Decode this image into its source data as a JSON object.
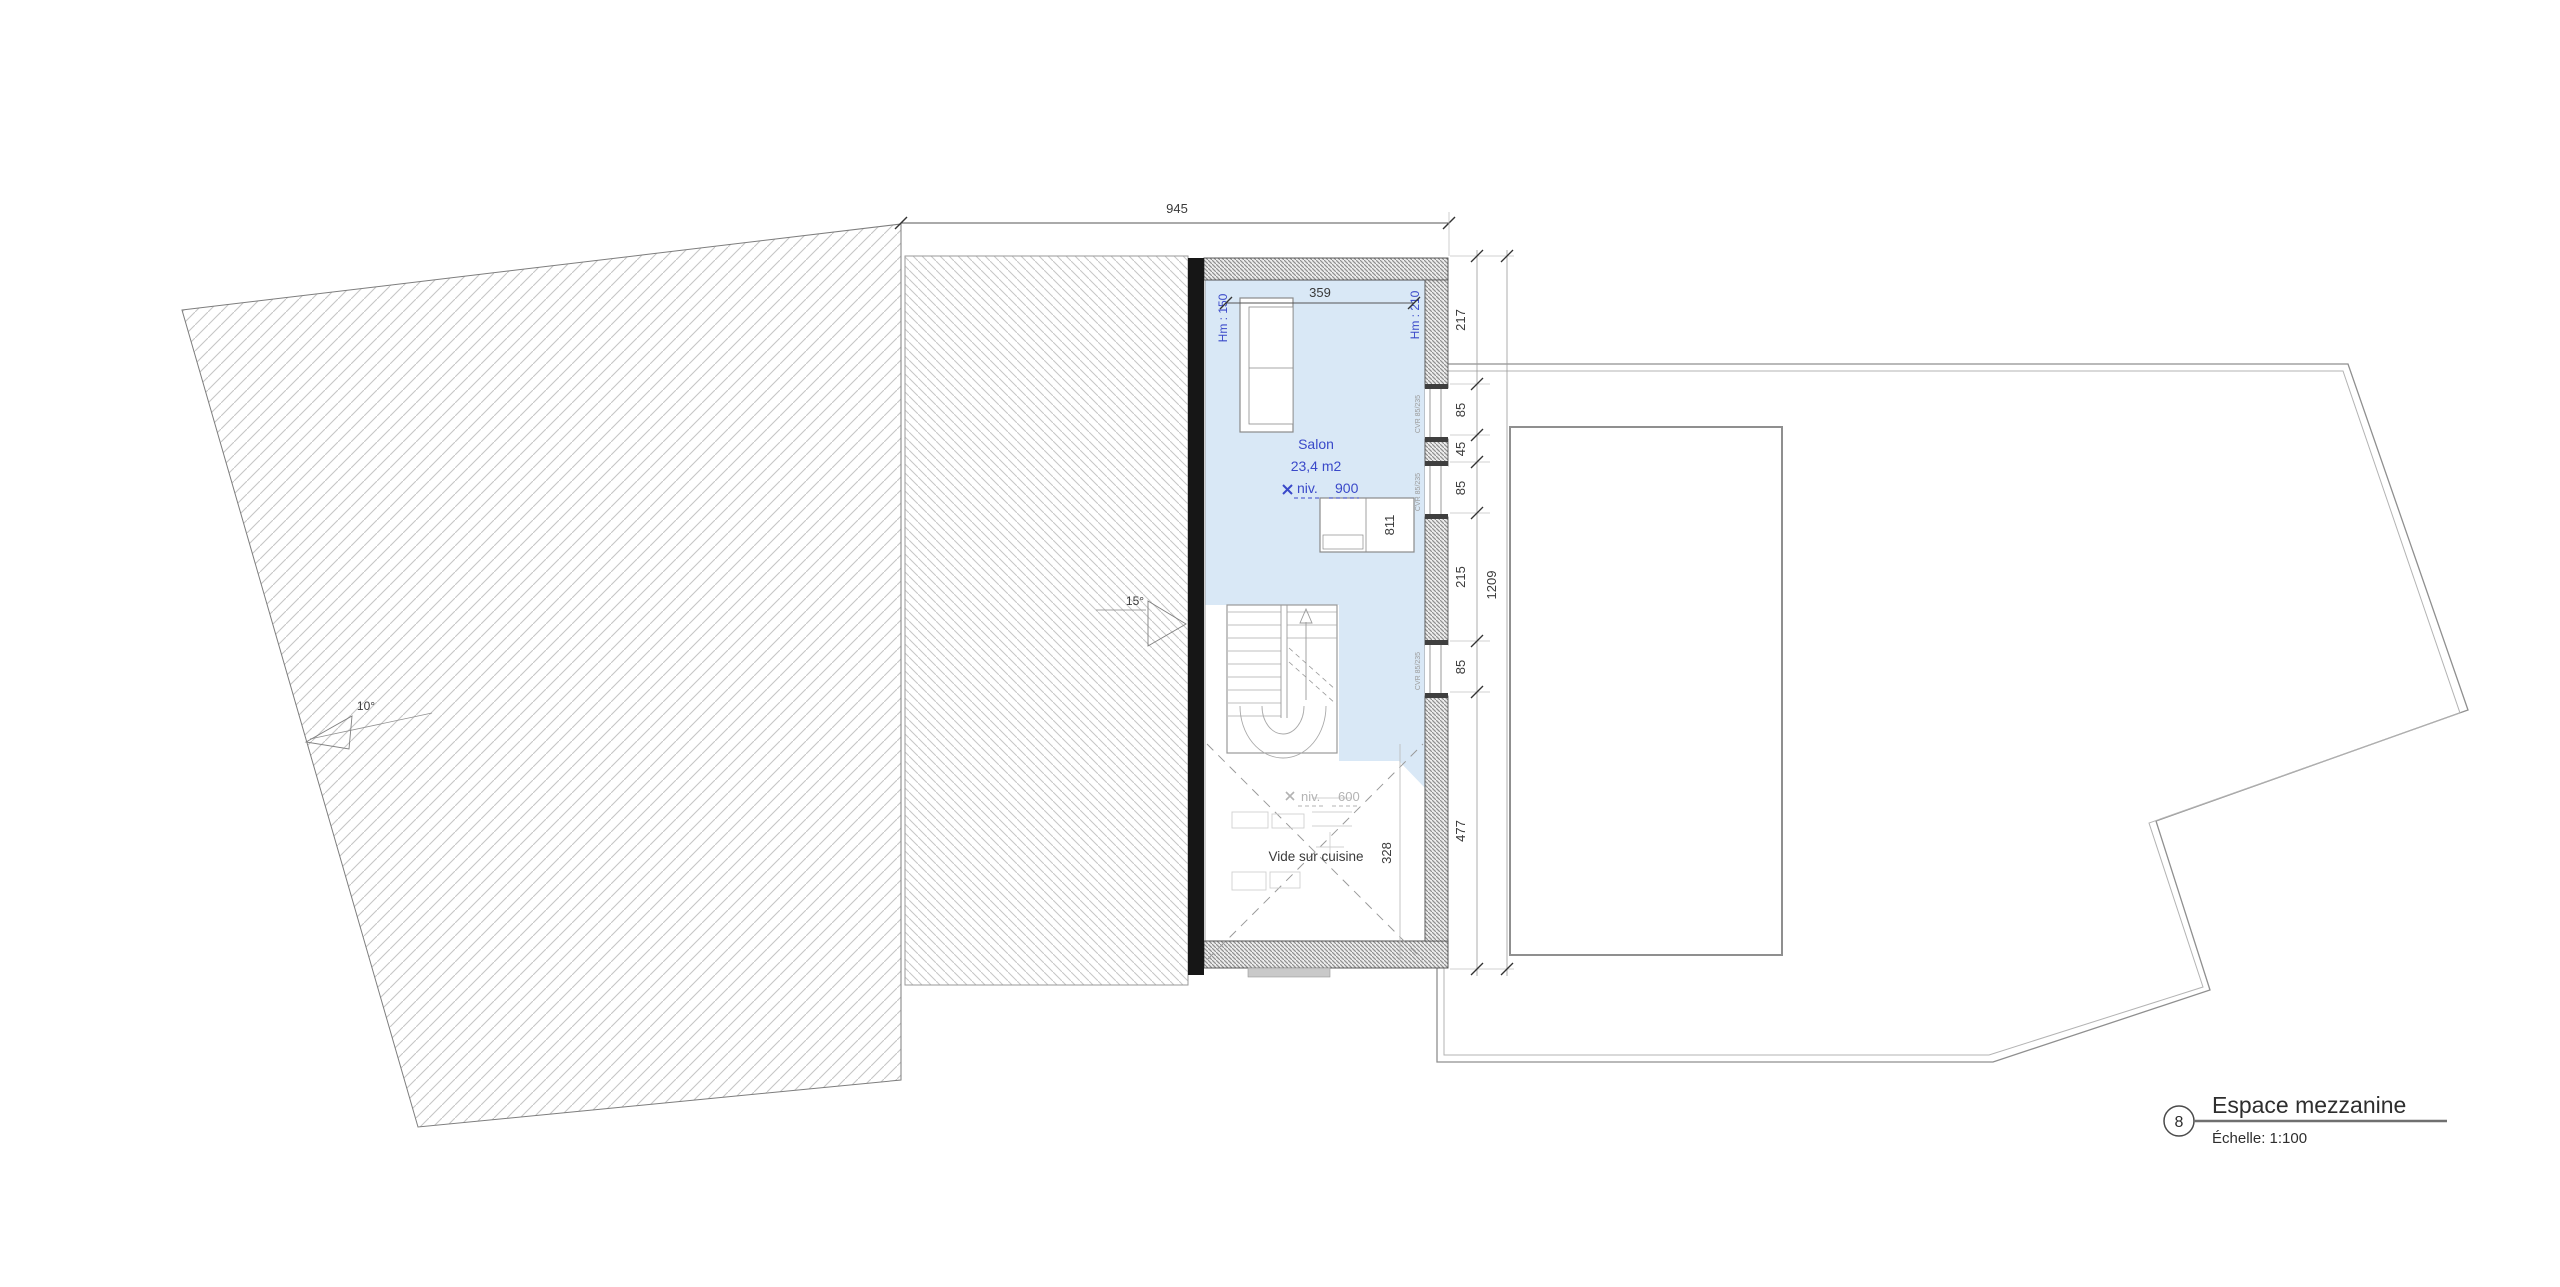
{
  "plan": {
    "dims": {
      "top_width": "945",
      "salon_width": "359",
      "right_chain": [
        "217",
        "85",
        "45",
        "85",
        "215",
        "85",
        "477"
      ],
      "right_total": "1209",
      "void_width": "328",
      "cabinet": "811"
    },
    "salon": {
      "name": "Salon",
      "area": "23,4 m2",
      "niv_label": "niv.",
      "niv_value": "900",
      "hm_left": "Hm : 150",
      "hm_right": "Hm : 210"
    },
    "void": {
      "label": "Vide sur cuisine",
      "niv_label": "niv.",
      "niv_value": "600"
    },
    "slopes": {
      "left": "10°",
      "mid": "15°"
    },
    "window_label": "CVR 85/235",
    "title_block": {
      "number": "8",
      "title": "Espace mezzanine",
      "scale": "Échelle: 1:100"
    },
    "colors": {
      "room_fill": "#d9e8f6",
      "annotation_blue": "#3a49c9",
      "hatch_gray": "#c6c6c6",
      "wall_dark": "#161616",
      "line_gray": "#8f8f8f"
    }
  }
}
